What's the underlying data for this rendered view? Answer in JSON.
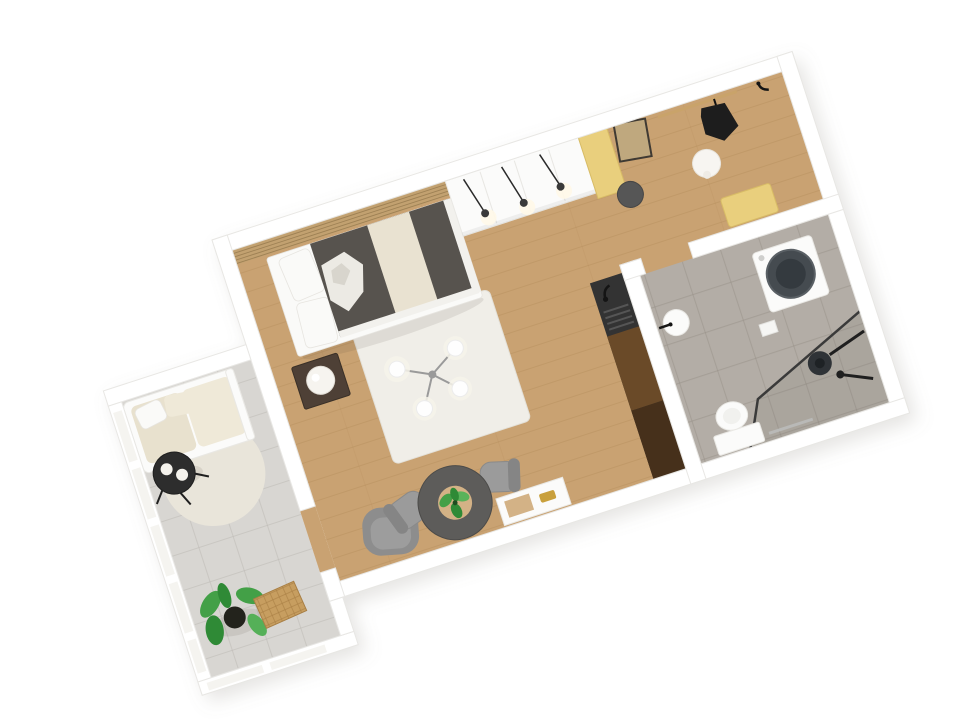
{
  "scene": {
    "type": "3d-floor-plan-render",
    "description": "Isometric 3D rendering of a studio apartment floor plan, rotated, on a white background. No text is visible in the image.",
    "rotation_deg": -18,
    "rooms": [
      {
        "name": "living-bedroom",
        "floor": "oak-wood",
        "items": [
          "wood-slat-headboard-wall",
          "double-bed",
          "white-pillows",
          "cream-throw",
          "nightstand",
          "bedside-lamp",
          "wardrobe",
          "yellow-accent-panel",
          "pendant-spot-lights",
          "area-rug",
          "sputnik-chandelier",
          "gray-armchair",
          "round-dining-table",
          "table-plant",
          "dining-chairs",
          "wall-console",
          "kitchen-counter",
          "sink-faucet"
        ]
      },
      {
        "name": "entry-hall",
        "floor": "oak-wood",
        "items": [
          "leaning-mirror",
          "round-stool",
          "sphere-pendant-lamp",
          "coat-rail",
          "hanging-jacket",
          "entry-door",
          "door-handle",
          "yellow-bench"
        ]
      },
      {
        "name": "bathroom",
        "floor": "gray-tile",
        "items": [
          "washing-machine",
          "shower-glass-partition",
          "rain-shower-head",
          "shower-column",
          "toilet",
          "towel-rail",
          "corner-sink",
          "sink-faucet",
          "wall-shelf"
        ]
      },
      {
        "name": "balcony",
        "floor": "gray-tile",
        "items": [
          "glazed-windows",
          "outdoor-sofa",
          "seat-cushions",
          "coffee-table",
          "white-cups",
          "round-rug",
          "potted-plant",
          "wicker-mat"
        ]
      }
    ]
  },
  "colors": {
    "wall": "#ffffff",
    "wallEdge": "#e8e7e4",
    "wood": "#c9a272",
    "woodLine": "#a87f4e",
    "bathTile": "#b3ada6",
    "bathGrout": "#958e86",
    "balcTile": "#d8d6d2",
    "balcGrout": "#bdbab4",
    "rug": "#f0eee8",
    "balcRug": "#e9e5da",
    "duvet": "#57534e",
    "throwCream": "#e9e2d1",
    "linen": "#fafaf8",
    "slat": "#c2a170",
    "slatLine": "#8f7348",
    "accent": "#e9cf7d",
    "accentEdge": "#d8bc66",
    "darkFurn": "#2d2d2d",
    "grayTable": "#5d5c5a",
    "chairGray": "#9b9b9b",
    "counterDark": "#333333",
    "counterWood": "#6a4a28",
    "counterWoodDark": "#46301b",
    "green": "#43a047",
    "greenDark": "#2f8a36",
    "pot": "#23231c",
    "black": "#1d1d1d",
    "chrome": "#b9b9b7",
    "gold": "#c9a03c",
    "tanWood": "#d3b286",
    "drum": "#454b50",
    "mirrorGlass": "#bfa87e",
    "cushionCream": "#e8e1ce",
    "cushionCream2": "#efe9d8",
    "glassPane": "#f5f4f0",
    "wickerTan": "#c79e60"
  }
}
